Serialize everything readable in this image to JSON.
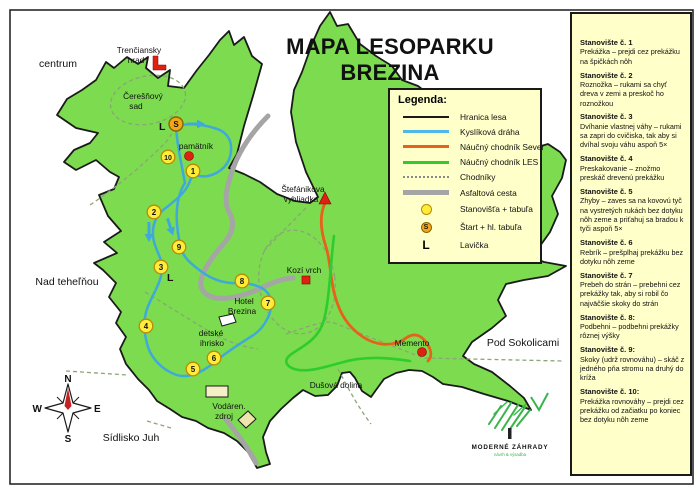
{
  "title": "MAPA LESOPARKU BREZINA",
  "legend": {
    "title": "Legenda:",
    "items": [
      {
        "label": "Hranica lesa"
      },
      {
        "label": "Kyslíková dráha"
      },
      {
        "label": "Náučný chodník Sever"
      },
      {
        "label": "Náučný chodník LES"
      },
      {
        "label": "Chodníky"
      },
      {
        "label": "Asfaltová cesta"
      },
      {
        "label": "Stanovišťa + tabuľa"
      },
      {
        "label": "Štart + hl. tabuľa"
      },
      {
        "label": "Lavička"
      }
    ]
  },
  "map": {
    "labels": {
      "centrum": "centrum",
      "nad_tehelnou": "Nad teheľňou",
      "sidlisko_juh": "Sídlisko Juh",
      "pod_sokolicami": "Pod Sokolicami",
      "dusova_dolina": "Dušová dolina",
      "memento": "Memento",
      "kozi_vrch": "Kozí vrch",
      "hrad1": "Trenčiansky",
      "hrad2": "hrad",
      "sad1": "Čerešňový",
      "sad2": "sad",
      "pamatnik": "pamätník",
      "vyhliadka1": "Štefánikova",
      "vyhliadka2": "vyhliadka",
      "hotel1": "Hotel",
      "hotel2": "Brezina",
      "ihrisko1": "detské",
      "ihrisko2": "ihrisko",
      "vodaren1": "Vodáren.",
      "vodaren2": "zdroj"
    },
    "symbols": {
      "start": "S",
      "bench": "L"
    },
    "stations": [
      "1",
      "2",
      "3",
      "4",
      "5",
      "6",
      "7",
      "8",
      "9",
      "10"
    ]
  },
  "compass": {
    "n": "N",
    "s": "S",
    "e": "E",
    "w": "W"
  },
  "logo": {
    "name": "MODERNÉ ZÁHRADY",
    "tagline": "návrh & výsadba"
  },
  "sidebar": {
    "stations": [
      {
        "title": "Stanovište č. 1",
        "desc": "Prekážka – prejdi cez prekážku na špičkách nôh"
      },
      {
        "title": "Stanovište č. 2",
        "desc": "Roznožka – rukami sa chyť dreva v zemi a preskoč ho roznožkou"
      },
      {
        "title": "Stanovište č. 3",
        "desc": "Dvíhanie vlastnej váhy – rukami sa zapri do cvičiska, tak aby si dvíhal svoju váhu aspoň 5×"
      },
      {
        "title": "Stanovište č. 4",
        "desc": "Preskakovanie – znožmo preskáč drevenú prekážku"
      },
      {
        "title": "Stanovište č. 5",
        "desc": "Zhyby – zaves sa na kovovú tyč na vystretých rukách bez dotyku nôh zeme a priťahuj sa bradou k tyči aspoň 5×"
      },
      {
        "title": "Stanovište č. 6",
        "desc": "Rebrík – prešplhaj prekážku bez dotyku nôh zeme"
      },
      {
        "title": "Stanovište č. 7",
        "desc": "Prebeh do strán – prebehni cez prekážky tak, aby si robil čo najväčšie skoky do strán"
      },
      {
        "title": "Stanovište č. 8:",
        "desc": "Podbehni – podbehni prekážky rôznej výšky"
      },
      {
        "title": "Stanovište č. 9:",
        "desc": "Skoky (udrž rovnováhu) – skáč z jedného pňa stromu na druhý do kríža"
      },
      {
        "title": "Stanovište č. 10:",
        "desc": "Prekážka rovnováhy – prejdi cez prekážku od začiatku po koniec bez dotyku nôh zeme"
      }
    ]
  },
  "colors": {
    "forest": "#7CDB4F",
    "trail_blue": "#3FA9DC",
    "trail_orange": "#E8611B",
    "trail_green": "#2ECC2E",
    "road_gray": "#A5A5A5",
    "panel_bg": "#FFFFC9",
    "station_yellow": "#FFEC3D",
    "start_orange": "#F2A71B",
    "marker_red": "#DE2110"
  }
}
